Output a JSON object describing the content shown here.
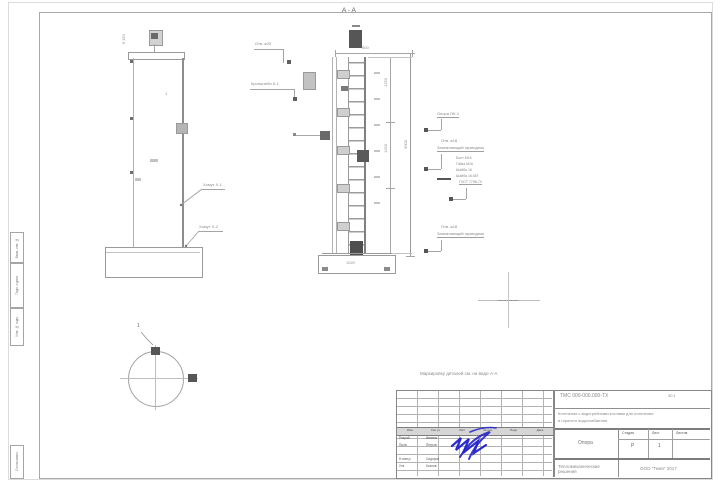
{
  "palette": {
    "line_gray": "#a5a5a5",
    "dark_detail": "#565656",
    "signature_blue": "#2222cc"
  },
  "views": {
    "section_label": "А-А",
    "note": "Маркировку деталей см. на виде А-А",
    "elevation": {
      "top_dim": "⌀159",
      "pos": "1",
      "callout_upper": "Хомут Х-1",
      "callout_lower": "Хомут Х-2"
    },
    "section": {
      "callout_hole": "Отв. ⌀20",
      "callout_bracket": "Кронштейн К-1",
      "dim_top": "600",
      "dim_mid1": "1250",
      "dim_mid2": "1250",
      "dim_overall": "9000",
      "dim_base": "1020"
    },
    "plan": {
      "pos": "1"
    },
    "notes_right": {
      "n1": "Опора ОК-1",
      "n2a": "Отв. ⌀18",
      "n2b": "Заземляющий проводник",
      "n3": [
        "Болт М16",
        "Гайка М16",
        "Шайба 16",
        "Шайба 16.65Г",
        "ГОСТ 7798-70"
      ],
      "n4a": "Отв. ⌀18",
      "n4b": "Заземляющий проводник"
    }
  },
  "titleblock": {
    "doc_number": "ТМС 000-000.000-ТХ",
    "doc_extra": "30.1",
    "project_line1": "Котельная с водогрейными котлами для отопления",
    "project_line2": "и горячего водоснабжения",
    "drawing_name": "Опора",
    "stage_label": "Стадия",
    "sheet_label": "Лист",
    "sheets_label": "Листов",
    "stage_value": "Р",
    "sheet_value": "1",
    "discipline": "Тепломеханические решения",
    "company": "ООО \"Темп\" 2017",
    "rev_headers": [
      "Изм.",
      "Кол.уч.",
      "Лист",
      "№ док.",
      "Подп.",
      "Дата"
    ],
    "signers": [
      {
        "role": "Разраб.",
        "name": "Иванов"
      },
      {
        "role": "Пров.",
        "name": "Петров"
      },
      {
        "role": "",
        "name": ""
      },
      {
        "role": "Н.контр.",
        "name": "Сидоров"
      },
      {
        "role": "Утв.",
        "name": "Козлов"
      }
    ]
  },
  "margin_stamps": {
    "s1": "Взам. инв. №",
    "s2": "Подп. и дата",
    "s3": "Инв. № подл.",
    "s4": "Согласовано"
  }
}
